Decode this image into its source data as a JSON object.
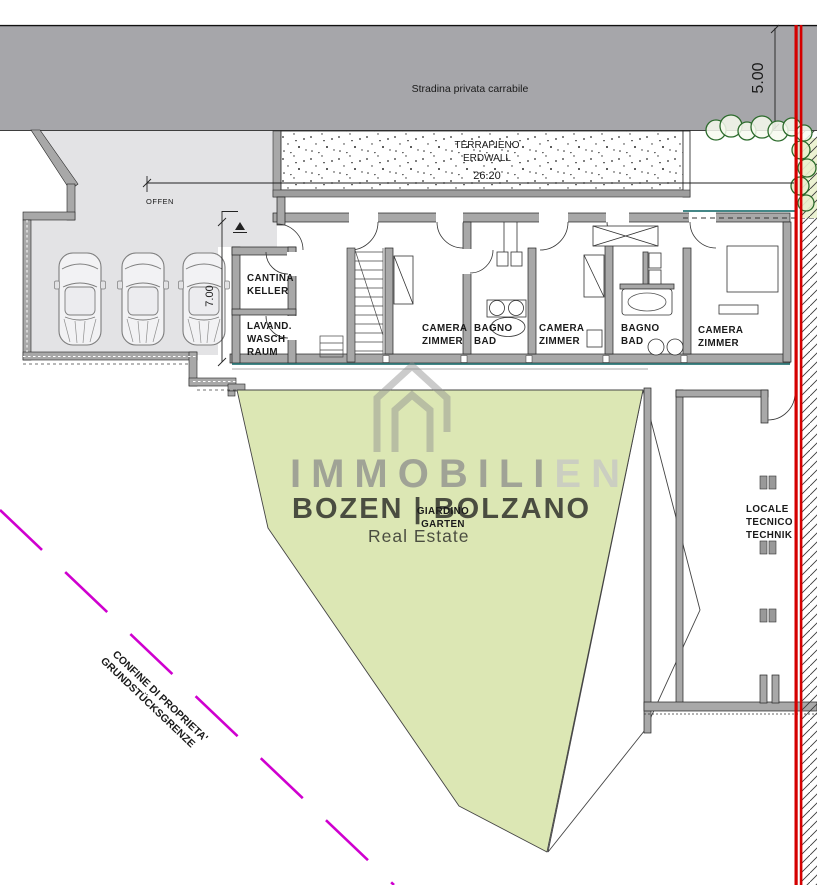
{
  "road": {
    "label": "Stradina privata carrabile"
  },
  "dimensions": {
    "road_width": "5.00",
    "terrapieno_length": "26.20",
    "garage_depth": "7.00"
  },
  "labels": {
    "offen": "OFFEN",
    "terrapieno": [
      "TERRAPIENO",
      "ERDWALL"
    ],
    "giardino": [
      "GIARDINO",
      "GARTEN"
    ]
  },
  "rooms": {
    "cantina": [
      "CANTINA",
      "KELLER"
    ],
    "lavanderia": [
      "LAVAND.",
      "WASCH",
      "RAUM"
    ],
    "camera1": [
      "CAMERA",
      "ZIMMER"
    ],
    "bagno1": [
      "BAGNO",
      "BAD"
    ],
    "camera2": [
      "CAMERA",
      "ZIMMER"
    ],
    "bagno2": [
      "BAGNO",
      "BAD"
    ],
    "camera3": [
      "CAMERA",
      "ZIMMER"
    ],
    "locale_tecnico": [
      "LOCALE",
      "TECNICO",
      "TECHNIK"
    ]
  },
  "boundary": {
    "line1": "CONFINE DI PROPRIETA'",
    "line2": "GRUNDSTÜCKSGRENZE"
  },
  "watermark": {
    "brand_dark": "IMMOBILI",
    "brand_light": "EN",
    "city": "BOZEN | BOLZANO",
    "tagline": "Real Estate"
  },
  "colors": {
    "road": "#a6a6aa",
    "garage_floor": "#e3e3e5",
    "wall": "#a8a8a8",
    "garden": "#dce7b4",
    "boundary_magenta": "#cf00cf",
    "marker_red": "#d40000",
    "teal": "#2a7676"
  }
}
